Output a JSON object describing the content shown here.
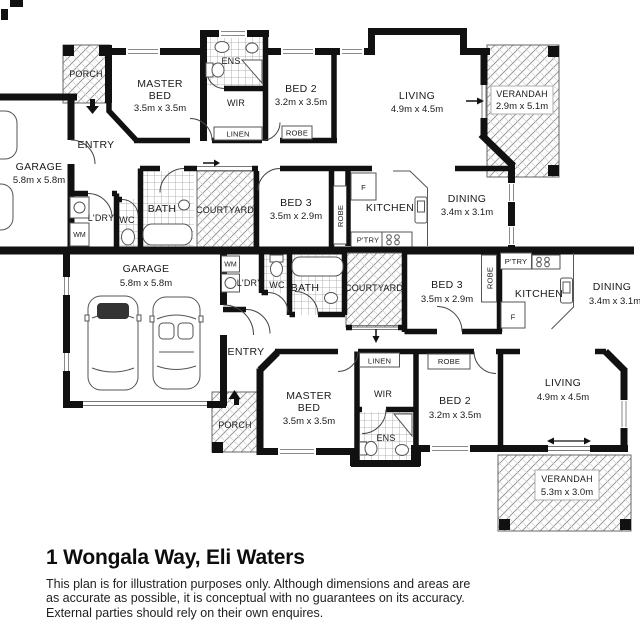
{
  "title_block": {
    "address_title": "1 Wongala Way, Eli Waters",
    "disclaimer_lines": [
      "This plan is for illustration purposes only.  Although dimensions and areas are",
      "as accurate as possible, it is conceptual with no guarantees on its accuracy.",
      "External parties should rely on their own enquires."
    ]
  },
  "colors": {
    "wall": "#111111",
    "text": "#1a1a1a",
    "hatch_line": "#8f8f8f",
    "tile_line": "#9f9f9f",
    "fixture_line": "#555555"
  },
  "units": {
    "top": {
      "rooms": {
        "garage": {
          "name": "GARAGE",
          "dims": "5.8m x 5.8m"
        },
        "porch": {
          "name": "PORCH"
        },
        "entry": {
          "name": "ENTRY"
        },
        "master_bed": {
          "name_line1": "MASTER",
          "name_line2": "BED",
          "dims": "3.5m x 3.5m"
        },
        "ens": {
          "name": "ENS"
        },
        "wir": {
          "name": "WIR"
        },
        "linen": {
          "name": "LINEN"
        },
        "bed2": {
          "name": "BED 2",
          "dims": "3.2m x 3.5m"
        },
        "bed2_robe": {
          "name": "ROBE"
        },
        "living": {
          "name": "LIVING",
          "dims": "4.9m x 4.5m"
        },
        "verandah": {
          "name": "VERANDAH",
          "dims": "2.9m x 5.1m"
        },
        "washing_machine": {
          "name": "WM"
        },
        "laundry": {
          "name": "L'DRY"
        },
        "wc": {
          "name": "WC"
        },
        "bath": {
          "name": "BATH"
        },
        "courtyard": {
          "name": "COURTYARD"
        },
        "bed3": {
          "name": "BED 3",
          "dims": "3.5m x 2.9m"
        },
        "bed3_robe": {
          "name": "ROBE"
        },
        "fridge": {
          "name": "F"
        },
        "kitchen": {
          "name": "KITCHEN"
        },
        "pantry": {
          "name": "P'TRY"
        },
        "dining": {
          "name": "DINING",
          "dims": "3.4m x 3.1m"
        }
      }
    },
    "bottom": {
      "rooms": {
        "garage": {
          "name": "GARAGE",
          "dims": "5.8m x 5.8m"
        },
        "porch": {
          "name": "PORCH"
        },
        "entry": {
          "name": "ENTRY"
        },
        "master_bed": {
          "name_line1": "MASTER",
          "name_line2": "BED",
          "dims": "3.5m x 3.5m"
        },
        "ens": {
          "name": "ENS"
        },
        "wir": {
          "name": "WIR"
        },
        "linen": {
          "name": "LINEN"
        },
        "bed2": {
          "name": "BED 2",
          "dims": "3.2m x 3.5m"
        },
        "bed2_robe": {
          "name": "ROBE"
        },
        "living": {
          "name": "LIVING",
          "dims": "4.9m x 4.5m"
        },
        "verandah": {
          "name": "VERANDAH",
          "dims": "5.3m x 3.0m"
        },
        "washing_machine": {
          "name": "WM"
        },
        "laundry": {
          "name": "L'DRY"
        },
        "wc": {
          "name": "WC"
        },
        "bath": {
          "name": "BATH"
        },
        "courtyard": {
          "name": "COURTYARD"
        },
        "bed3": {
          "name": "BED 3",
          "dims": "3.5m x 2.9m"
        },
        "bed3_robe": {
          "name": "ROBE"
        },
        "fridge": {
          "name": "F"
        },
        "kitchen": {
          "name": "KITCHEN"
        },
        "pantry": {
          "name": "P'TRY"
        },
        "dining": {
          "name": "DINING",
          "dims": "3.4m x 3.1m"
        }
      }
    }
  }
}
